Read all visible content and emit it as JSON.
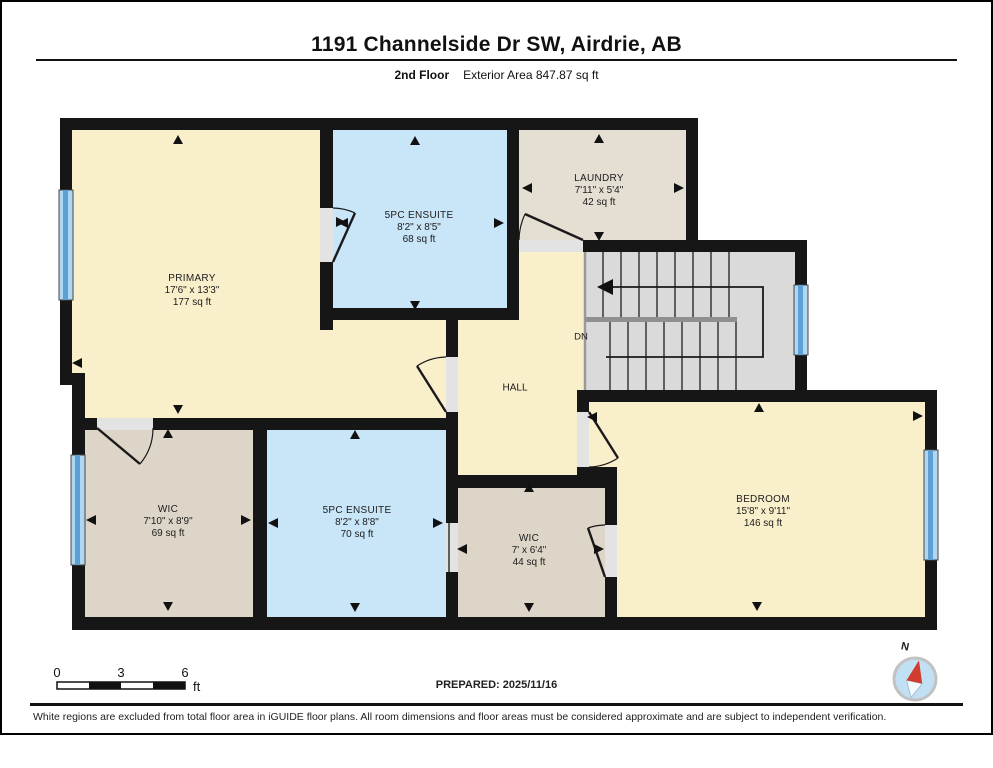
{
  "header": {
    "title": "1191 Channelside Dr SW, Airdrie, AB",
    "floor_label": "2nd Floor",
    "area_label": "Exterior Area 847.87 sq ft"
  },
  "rooms": {
    "primary": {
      "name": "PRIMARY",
      "dims": "17'6\" x 13'3\"",
      "area": "177 sq ft"
    },
    "ensuite_top": {
      "name": "5PC ENSUITE",
      "dims": "8'2\" x 8'5\"",
      "area": "68 sq ft"
    },
    "laundry": {
      "name": "LAUNDRY",
      "dims": "7'11\" x 5'4\"",
      "area": "42 sq ft"
    },
    "hall": {
      "name": "HALL"
    },
    "stairs": {
      "dn": "DN"
    },
    "wic_left": {
      "name": "WIC",
      "dims": "7'10\" x 8'9\"",
      "area": "69 sq ft"
    },
    "ensuite_bottom": {
      "name": "5PC ENSUITE",
      "dims": "8'2\" x 8'8\"",
      "area": "70 sq ft"
    },
    "wic_bottom": {
      "name": "WIC",
      "dims": "7' x 6'4\"",
      "area": "44 sq ft"
    },
    "bedroom": {
      "name": "BEDROOM",
      "dims": "15'8\" x 9'11\"",
      "area": "146 sq ft"
    }
  },
  "scale": {
    "ticks": [
      "0",
      "3",
      "6"
    ],
    "unit": "ft"
  },
  "prepared_label": "PREPARED: 2025/11/16",
  "compass": {
    "north": "N"
  },
  "disclaimer": "White regions are excluded from total floor area in iGUIDE floor plans. All room dimensions and floor areas must be considered approximate and are subject to independent verification.",
  "colors": {
    "floor_cream": "#FAEFCB",
    "floor_blue": "#C9E5F8",
    "floor_tan": "#DDD5C7",
    "floor_tan_light": "#E5DED2",
    "stairs_gray": "#DADADA",
    "wall_black": "#161616",
    "window_blue": "#5E9FD4",
    "compass_red": "#D23B2F"
  }
}
